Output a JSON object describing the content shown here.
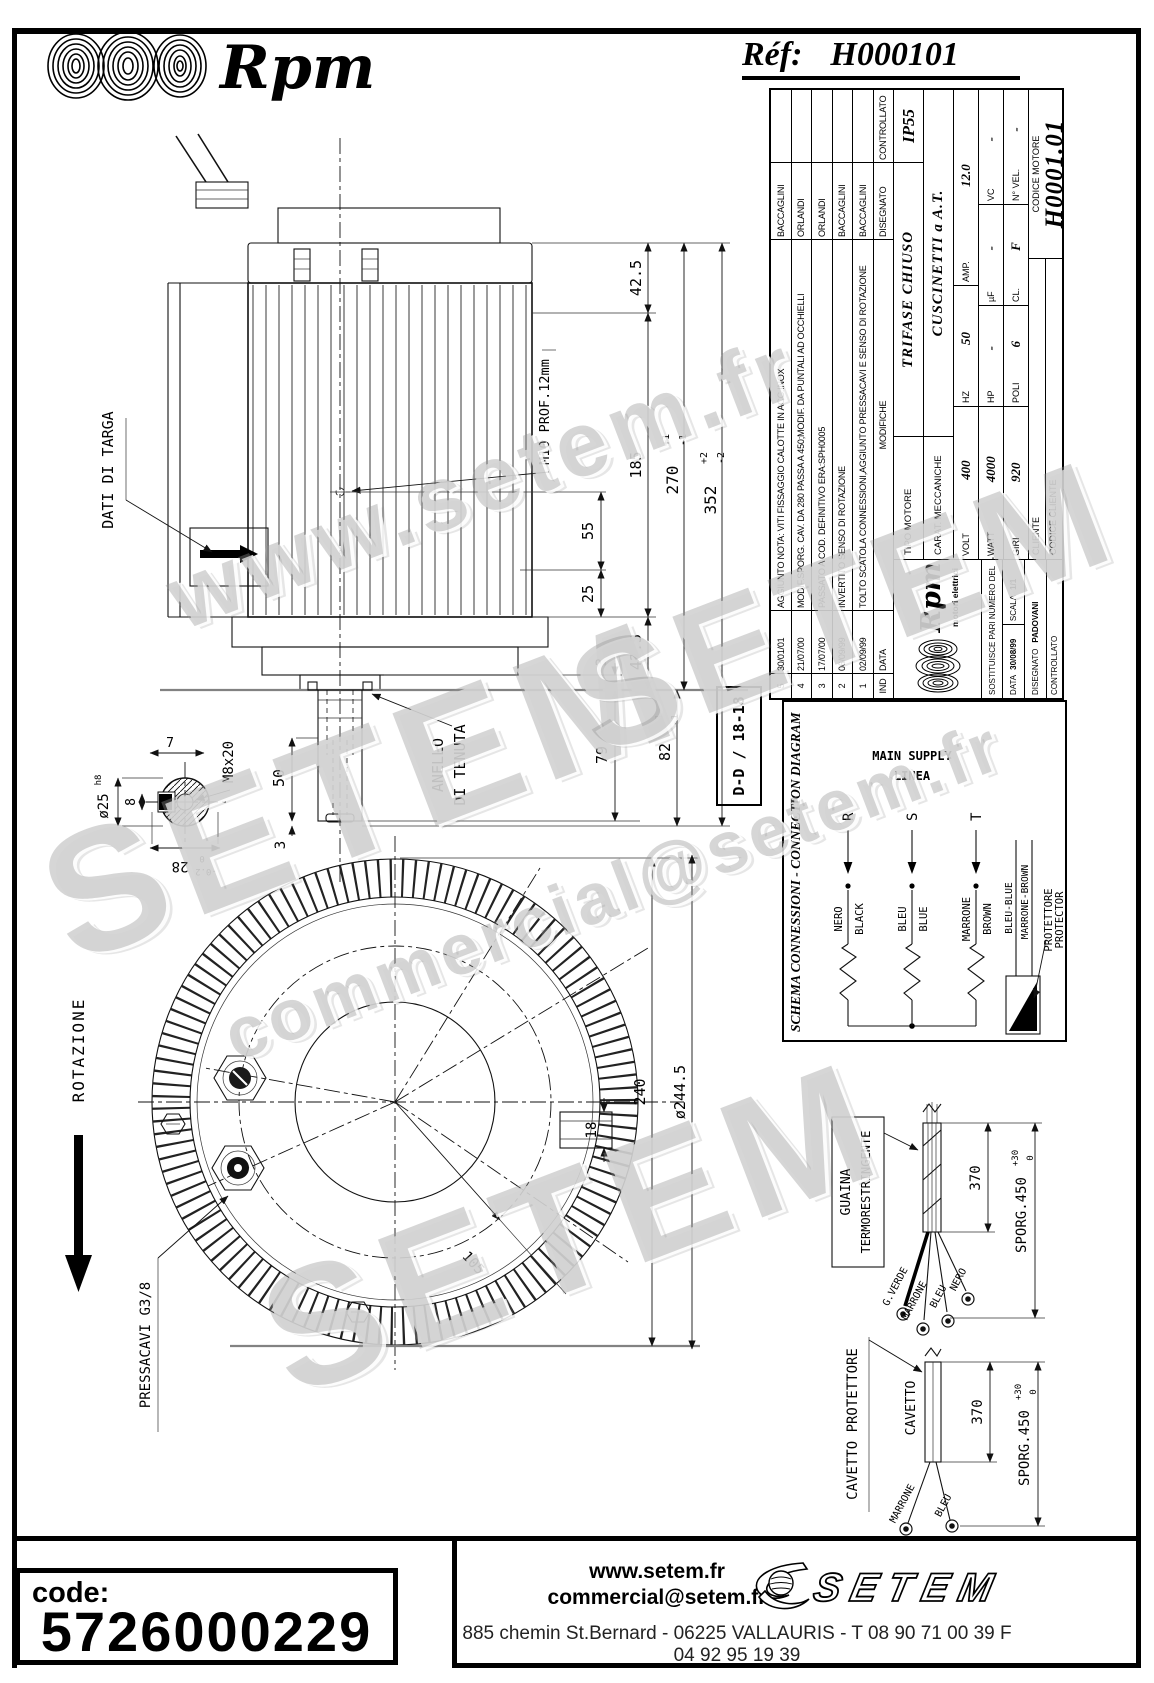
{
  "header": {
    "brand": "Rpm",
    "ref_label": "Réf:",
    "ref_value": "H000101"
  },
  "watermarks": {
    "w1": "www.setem.fr",
    "w2": "SETEM",
    "w3": "commercial@setem.fr",
    "w4": "SETEM",
    "w5": "SETEM"
  },
  "side_view": {
    "dati_di_targa": "DATI DI TARGA",
    "m10": "M10 PROF.12mm",
    "anello_line1": "ANELLO",
    "anello_line2": "DI TENUTA",
    "dim_top_425": "42.5",
    "dim_185": "185",
    "dim_270": "270",
    "dim_270_sup": "+1",
    "dim_270_sub": "-1",
    "dim_352": "352",
    "dim_352_sup": "+2",
    "dim_352_sub": "-2",
    "dim_55": "55",
    "dim_25": "25",
    "dim_bot_425": "42.5",
    "dim_3_flange": "3",
    "dim_79": "79",
    "dim_82": "82",
    "dim_82_sup": "+1",
    "dim_82_sub": "-1",
    "dim_50": "50",
    "dim_3_shaft": "3"
  },
  "shaft_detail": {
    "dia": "ø25",
    "dia_tol": "h8",
    "dim_8": "8",
    "dim_7": "7",
    "m8": "M8x20",
    "dim_28": "28",
    "dim_28_sup": "0",
    "dim_28_sub": "-0.2"
  },
  "front_view": {
    "rotazione": "ROTAZIONE",
    "pressacavi": "PRESSACAVI G3/8",
    "dim_18": "18",
    "dim_240": "240",
    "dim_2445": "ø244.5",
    "dim_105": "105"
  },
  "connection": {
    "section": "D-D / 18-18",
    "title": "SCHEMA CONNESSIONI - CONNECTION DIAGRAM",
    "linea": "LINEA",
    "main_supply": "MAIN SUPPLY",
    "r": "R",
    "s": "S",
    "t": "T",
    "nero": "NERO",
    "black": "BLACK",
    "bleu": "BLEU",
    "blue": "BLUE",
    "marrone": "MARRONE",
    "brown": "BROWN",
    "bleu_blue": "BLEU-BLUE",
    "marrone_brown": "MARRONE-BROWN",
    "protettore": "PROTETTORE",
    "protector": "PROTECTOR"
  },
  "cable1": {
    "label_line1": "GUAINA",
    "label_line2": "TERMORESTRINGENTE",
    "dim_370": "370",
    "sporg": "SPORG.450",
    "sporg_sup": "+30",
    "sporg_sub": "0",
    "wire1": "G.VERDE",
    "wire2": "MARRONE",
    "wire3": "BLEU",
    "wire4": "NERO"
  },
  "cable2": {
    "label": "CAVETTO PROTETTORE",
    "cavetto": "CAVETTO",
    "dim_370": "370",
    "sporg": "SPORG.450",
    "sporg_sup": "+30",
    "sporg_sub": "0",
    "wire1": "MARRONE",
    "wire2": "BLEU"
  },
  "title_block": {
    "revisions": [
      {
        "ind": "5",
        "date": "30/01/01",
        "desc": "AGGIUNTO NOTA: VITI FISSAGGIO CALOTTE IN ACC.INOX",
        "by": "BACCAGLINI",
        "check": ""
      },
      {
        "ind": "4",
        "date": "21/07/00",
        "desc": "MODIF.SPORG. CAV. DA 280 PASSA A 450;MODIF. DA PUNTALI AD OCCHIELLI",
        "by": "ORLANDI",
        "check": ""
      },
      {
        "ind": "3",
        "date": "17/07/00",
        "desc": "PASSATO A COD. DEFINITIVO ERA:SPH0005",
        "by": "ORLANDI",
        "check": ""
      },
      {
        "ind": "2",
        "date": "06/09/99",
        "desc": "INVERTITO SENSO DI ROTAZIONE",
        "by": "BACCAGLINI",
        "check": ""
      },
      {
        "ind": "1",
        "date": "02/09/99",
        "desc": "TOLTO SCATOLA CONNESSIONI,AGGIUNTO PRESSACAVI E SENSO DI ROTAZIONE",
        "by": "BACCAGLINI",
        "check": ""
      }
    ],
    "rev_headers": {
      "ind": "IND",
      "date": "DATA",
      "desc": "MODIFICHE",
      "by": "DISEGNATO",
      "check": "CONTROLLATO"
    },
    "tipo_label": "TIPO MOTORE",
    "tipo_value": "TRIFASE CHIUSO",
    "ip": "IP55",
    "carat_label": "CARAT. MECCANICHE",
    "carat_value": "CUSCINETTI a A.T.",
    "volt_label": "VOLT",
    "volt": "400",
    "hz_label": "HZ",
    "hz": "50",
    "amp_label": "AMP.",
    "amp": "12.0",
    "watt_label": "WATT",
    "watt": "4000",
    "hp_label": "HP",
    "hp": "-",
    "uf_label": "µF",
    "uf": "-",
    "vc_label": "VC",
    "vc": "-",
    "giri_label": "GIRI",
    "giri": "920",
    "poli_label": "POLI",
    "poli": "6",
    "cl_label": "CL.",
    "cl": "F",
    "nvel_label": "N° VEL.",
    "nvel": "-",
    "logo_text": "Rpm",
    "logo_sub": "motori elettrici",
    "sostituisce_label": "SOSTITUISCE PARI NUMERO DEL",
    "sostituisce_value": "-",
    "data_label": "DATA",
    "data_value": "30/08/99",
    "scala_label": "SCALA",
    "scala_value": "1/1",
    "disegnato_label": "DISEGNATO",
    "disegnato_value": "PADOVANI",
    "controllato_label": "CONTROLLATO",
    "controllato_value": "",
    "cliente_label": "CLIENTE",
    "cliente_value": "",
    "codice_cliente_label": "CODICE CLIENTE",
    "codice_cliente_value": "",
    "codice_motore_label": "CODICE MOTORE",
    "codice_motore_value": "H0001.01"
  },
  "footer": {
    "code_label": "code:",
    "code_value": "5726000229",
    "website": "www.setem.fr",
    "email": "commercial@setem.fr",
    "address": "885 chemin St.Bernard  -  06225 VALLAURIS  -  T 08 90 71 00 39   F 04 92 95 19 39",
    "logo": "SETEM"
  }
}
